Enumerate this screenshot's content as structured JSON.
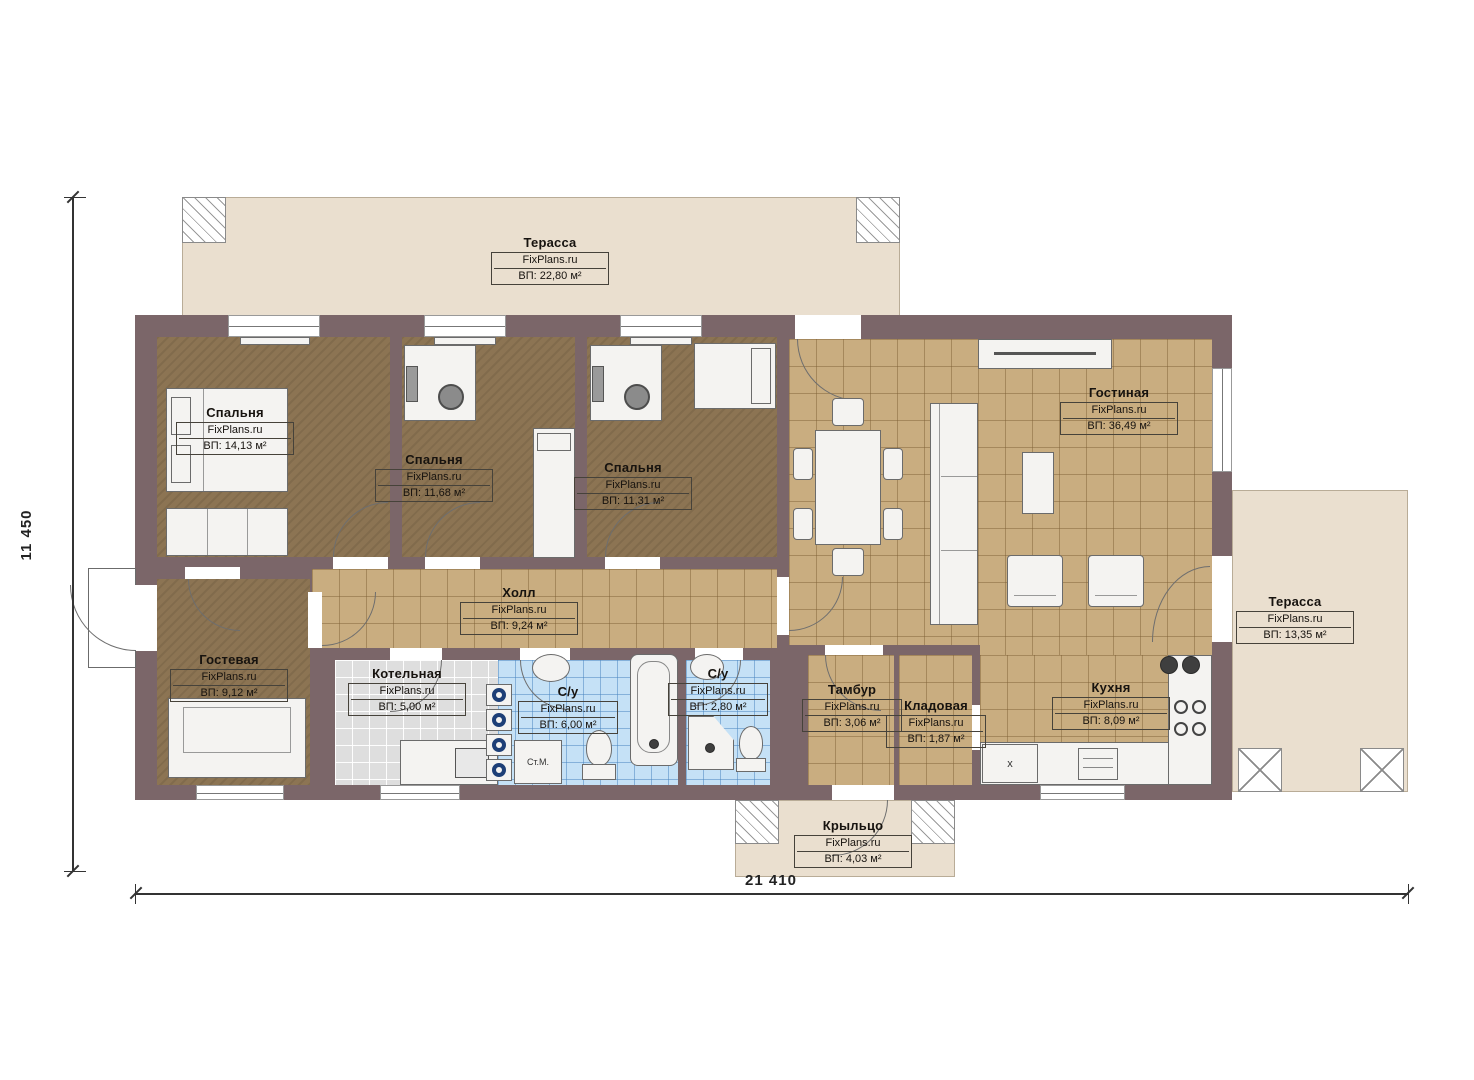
{
  "brand": "FixPlans.ru",
  "dimensions": {
    "height": "11 450",
    "width": "21 410"
  },
  "markers": {
    "washing_machine": "Ст.М.",
    "sink": "x"
  },
  "rooms": {
    "terrace_top": {
      "name": "Терасса",
      "area": "ВП: 22,80 м²"
    },
    "bedroom_1": {
      "name": "Спальня",
      "area": "ВП: 14,13 м²"
    },
    "bedroom_2": {
      "name": "Спальня",
      "area": "ВП: 11,68 м²"
    },
    "bedroom_3": {
      "name": "Спальня",
      "area": "ВП: 11,31 м²"
    },
    "living": {
      "name": "Гостиная",
      "area": "ВП: 36,49 м²"
    },
    "hall": {
      "name": "Холл",
      "area": "ВП: 9,24 м²"
    },
    "guest": {
      "name": "Гостевая",
      "area": "ВП: 9,12 м²"
    },
    "boiler": {
      "name": "Котельная",
      "area": "ВП: 5,00 м²"
    },
    "bath_1": {
      "name": "С/у",
      "area": "ВП: 6,00 м²"
    },
    "bath_2": {
      "name": "С/у",
      "area": "ВП: 2,80 м²"
    },
    "tambour": {
      "name": "Тамбур",
      "area": "ВП: 3,06 м²"
    },
    "storage": {
      "name": "Кладовая",
      "area": "ВП: 1,87 м²"
    },
    "kitchen": {
      "name": "Кухня",
      "area": "ВП: 8,09 м²"
    },
    "terrace_right": {
      "name": "Терасса",
      "area": "ВП: 13,35 м²"
    },
    "porch": {
      "name": "Крыльцо",
      "area": "ВП: 4,03 м²"
    }
  },
  "colors": {
    "wall": "#7b6669",
    "tile": "#c9ad80",
    "bedroom_floor": "#8c7453",
    "bath_tile": "#c5e1f6",
    "terrace": "#eadfcf",
    "boiler_tile": "#dedede"
  }
}
